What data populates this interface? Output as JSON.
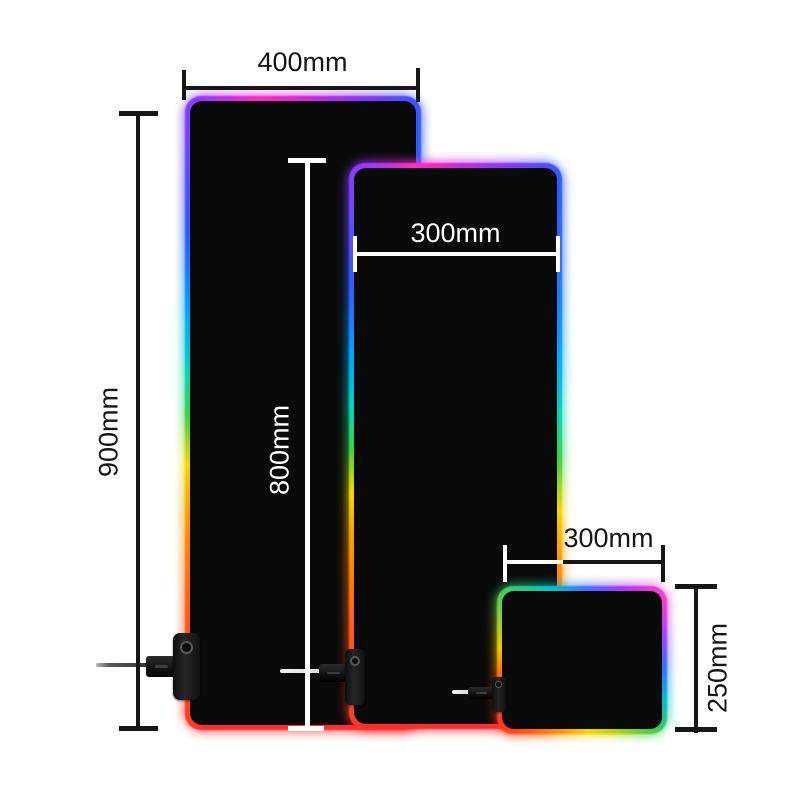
{
  "page": {
    "description": "RGB gaming mouse pad size comparison diagram",
    "background": "#ffffff"
  },
  "pads": {
    "large": {
      "name": "extended-mousepad-large",
      "width_label": "400mm",
      "height_label": "900mm"
    },
    "medium": {
      "name": "extended-mousepad-medium",
      "width_label": "300mm",
      "height_label": "800mm"
    },
    "small": {
      "name": "desk-mousepad-small",
      "width_label": "300mm",
      "height_label": "250mm"
    }
  },
  "colors": {
    "pad_surface": "#0a0a0a",
    "dimension_line_dark": "#161616",
    "dimension_line_light": "#ffffff",
    "rgb_border_top": "#d428d8",
    "rgb_border_bottom": "#ff2d2d"
  }
}
